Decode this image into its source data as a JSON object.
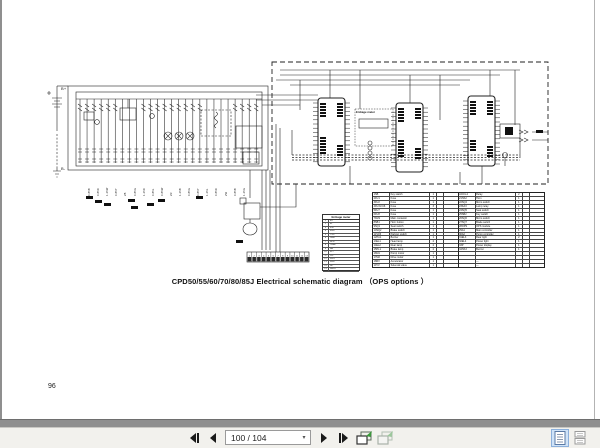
{
  "page": {
    "number_label": "96",
    "caption": "CPD50/55/60/70/80/85J Electrical schematic diagram （OPS   options ）"
  },
  "schematic": {
    "battery_positive_label": "B+",
    "battery_negative_label": "B-",
    "engage_meter_label": "EnGage meter",
    "fuse_label": "FU",
    "wire_labels": [
      "0.85B",
      "0.85R",
      "1.25W",
      "0.85Y",
      "2B",
      "0.85G",
      "1.25R",
      "0.85L",
      "0.85W",
      "2R",
      "1.25B",
      "0.85G",
      "0.85Y",
      "1.25L",
      "0.85R",
      "2W",
      "0.85B",
      "1.25G"
    ],
    "connector_strip_cells": [
      "1",
      "2",
      "3",
      "4",
      "5",
      "6",
      "7",
      "8",
      "9",
      "10",
      "11",
      "12",
      "13"
    ],
    "engage_meter_pins": [
      {
        "no": "1",
        "name": "B+"
      },
      {
        "no": "2",
        "name": "B-"
      },
      {
        "no": "3",
        "name": "KSI"
      },
      {
        "no": "4",
        "name": "RXD"
      },
      {
        "no": "5",
        "name": "TXD"
      },
      {
        "no": "6",
        "name": "GND"
      },
      {
        "no": "7",
        "name": "SPD"
      },
      {
        "no": "8",
        "name": "TEMP"
      },
      {
        "no": "9",
        "name": "HR"
      },
      {
        "no": "10",
        "name": "FLT"
      },
      {
        "no": "11",
        "name": "LVL"
      },
      {
        "no": "12",
        "name": "SW1"
      },
      {
        "no": "13",
        "name": "SW2"
      },
      {
        "no": "14",
        "name": "NC"
      },
      {
        "no": "15",
        "name": "SHLD"
      }
    ],
    "parts_table": {
      "left_rows": [
        [
          "1SB",
          "Key switch",
          "1",
          ""
        ],
        [
          "2FU1",
          "Fuse",
          "1",
          ""
        ],
        [
          "3FU2",
          "Fuse",
          "1",
          ""
        ],
        [
          "4FU3-FU6",
          "Fuse",
          "3",
          ""
        ],
        [
          "5FU7",
          "Fuse",
          "1",
          ""
        ],
        [
          "6FU8",
          "Fuse",
          "1",
          ""
        ],
        [
          "7KM1",
          "Main contactor",
          "1",
          ""
        ],
        [
          "8SB1",
          "Horn button",
          "1",
          ""
        ],
        [
          "9SQ1",
          "Seat switch",
          "1",
          ""
        ],
        [
          "10SQ2",
          "Brake switch",
          "1",
          ""
        ],
        [
          "11SQ3",
          "Parking switch",
          "1",
          ""
        ],
        [
          "12HA1",
          "Buzzer",
          "1",
          ""
        ],
        [
          "13EL1",
          "Head lamp",
          "2",
          ""
        ],
        [
          "14EL2",
          "Rear lamp",
          "2",
          ""
        ],
        [
          "15HL1",
          "Brake lamp",
          "2",
          ""
        ],
        [
          "16M1",
          "Pump motor",
          "1",
          ""
        ],
        [
          "17M2",
          "Drive motor",
          "1",
          ""
        ],
        [
          "18RV",
          "Accelerator",
          "1",
          ""
        ],
        [
          "19YV",
          "Solenoid valve",
          "1",
          ""
        ]
      ],
      "right_rows": [
        [
          "ACD1-2",
          "Relay",
          "2",
          ""
        ],
        [
          "21HA2",
          "Horn",
          "1",
          ""
        ],
        [
          "22SQ4",
          "Micro switch",
          "1",
          ""
        ],
        [
          "23KA3",
          "Lamp relay",
          "1",
          ""
        ],
        [
          "24SQ5",
          "Seat switch",
          "1",
          ""
        ],
        [
          "25SB2",
          "Key switch",
          "1",
          ""
        ],
        [
          "26SQ6",
          "Micro switch",
          "1",
          ""
        ],
        [
          "27SQ7",
          "Blade switch",
          "1",
          ""
        ],
        [
          "28OPS",
          "OPS module",
          "1",
          ""
        ],
        [
          "29A1",
          "Main controller",
          "1",
          ""
        ],
        [
          "30A2",
          "Pump controller",
          "1",
          ""
        ],
        [
          "31EL3",
          "Rear light",
          "2",
          ""
        ],
        [
          "32EL4",
          "Power light",
          "1",
          ""
        ],
        [
          "33P",
          "Power display",
          "1",
          ""
        ],
        [
          "34HA3",
          "Buzzer",
          "1",
          ""
        ],
        [
          "",
          "",
          "",
          ""
        ],
        [
          "",
          "",
          "",
          ""
        ],
        [
          "",
          "—",
          "",
          ""
        ],
        [
          "",
          "—",
          "",
          ""
        ]
      ]
    }
  },
  "toolbar": {
    "page_input_value": "100 / 104"
  }
}
